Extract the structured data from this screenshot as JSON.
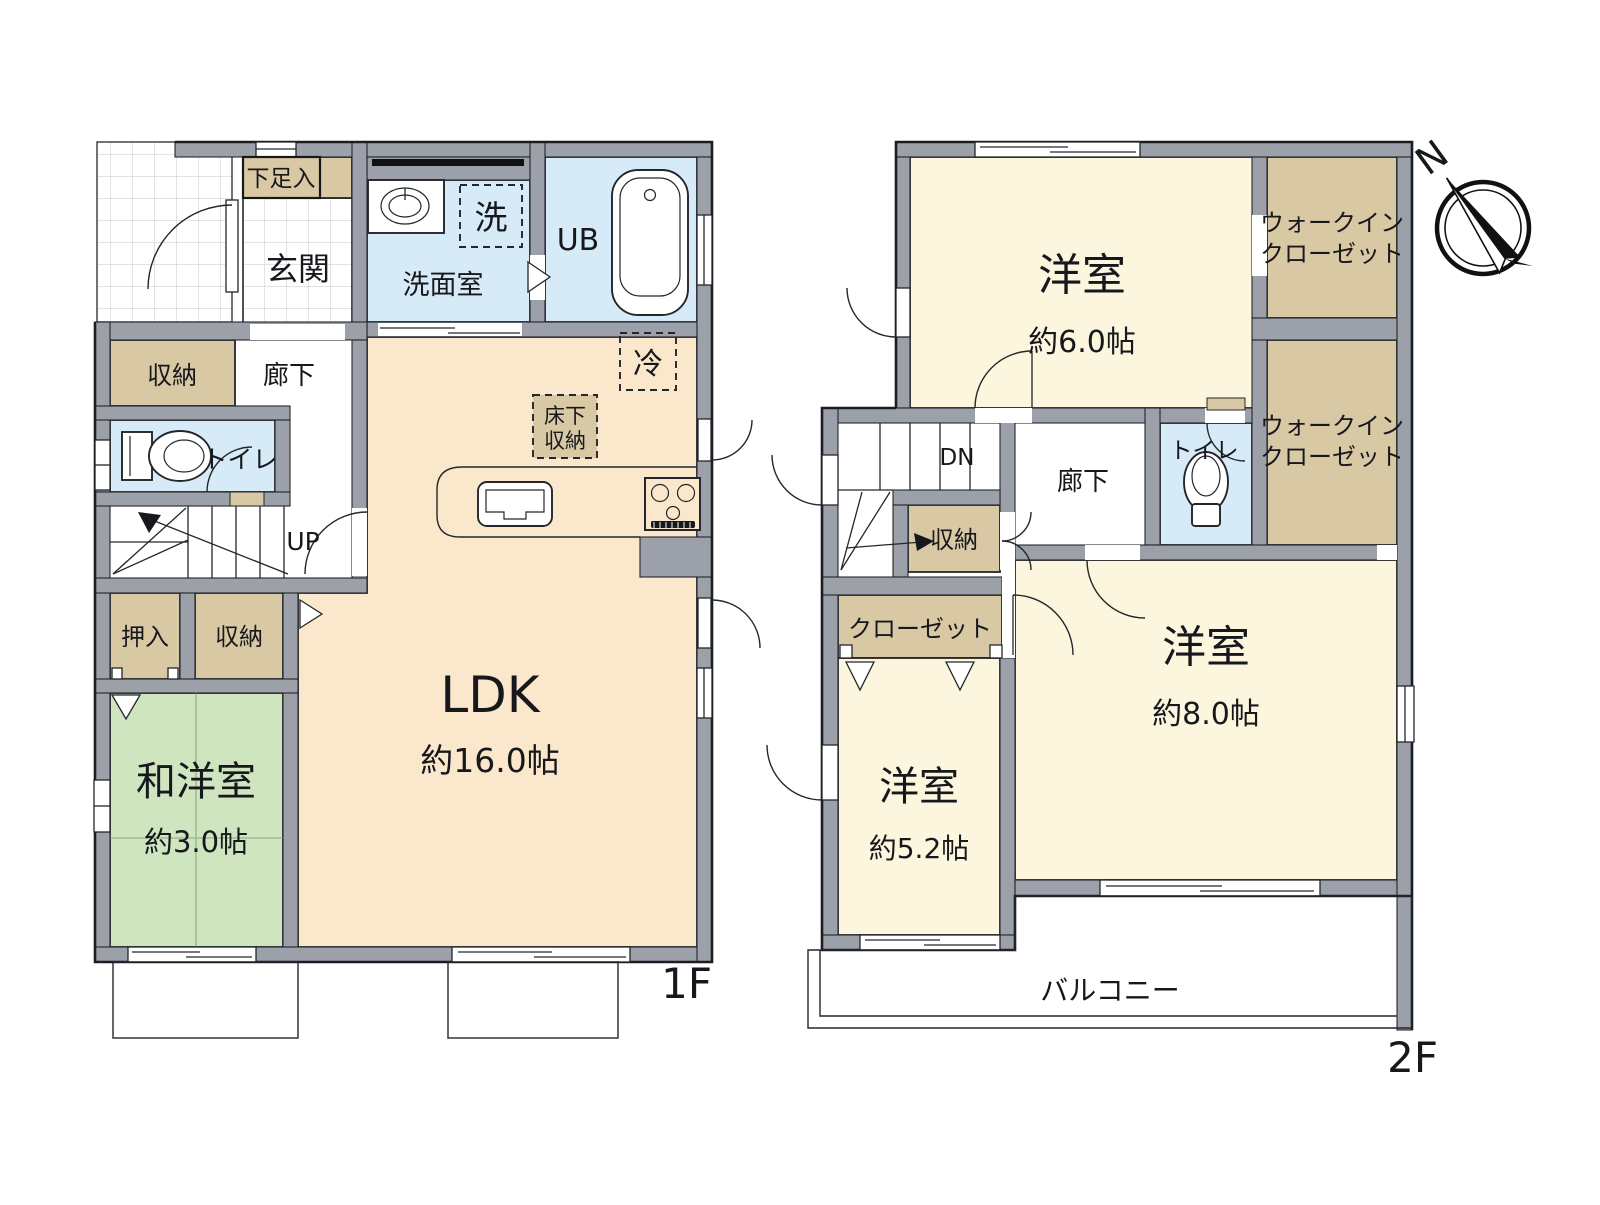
{
  "title": "間取り図",
  "colors": {
    "wall": "#9CA0A9",
    "ldk": "#FBE7CB",
    "bedroom": "#FCF6DF",
    "japanese_room": "#CFE5C0",
    "water_rooms": "#D7EAF8",
    "storage": "#D9C8A4",
    "outline": "#1a1d22"
  },
  "compass": {
    "north": "N"
  },
  "f1": {
    "floor_label": "1F",
    "shoe_cabinet": "下足入",
    "entrance": "玄関",
    "washroom": "洗面室",
    "washer_mark": "洗",
    "unit_bath": "UB",
    "corridor": "廊下",
    "storage_hall": "収納",
    "toilet": "トイレ",
    "stairs_up": "UP",
    "fridge_mark": "冷",
    "underfloor_line1": "床下",
    "underfloor_line2": "収納",
    "oshiire": "押入",
    "storage2": "収納",
    "japanese_room": "和洋室",
    "japanese_room_size": "約3.0帖",
    "ldk": "LDK",
    "ldk_size": "約16.0帖"
  },
  "f2": {
    "floor_label": "2F",
    "bedroom1": "洋室",
    "bedroom1_size": "約6.0帖",
    "wic1_line1": "ウォークイン",
    "wic1_line2": "クローゼット",
    "wic2_line1": "ウォークイン",
    "wic2_line2": "クローゼット",
    "stairs_down": "DN",
    "corridor": "廊下",
    "toilet": "トイレ",
    "storage": "収納",
    "closet": "クローゼット",
    "bedroom2": "洋室",
    "bedroom2_size": "約5.2帖",
    "bedroom3": "洋室",
    "bedroom3_size": "約8.0帖",
    "balcony": "バルコニー"
  }
}
